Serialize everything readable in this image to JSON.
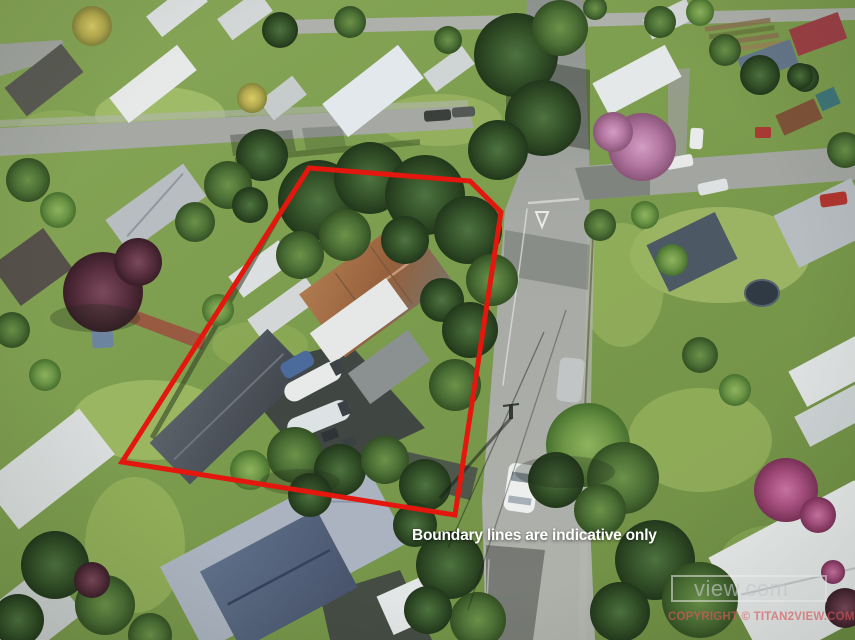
{
  "meta": {
    "type": "aerial-drone-photograph",
    "subject": "suburban residential property outlined with red boundary lines"
  },
  "overlay": {
    "caption": "Boundary lines are indicative only",
    "caption_color": "#ffffff",
    "boundary_color": "#e3170d",
    "boundary_points": "309,168 470,181 501,212 455,515 122,462"
  },
  "watermarks": {
    "box_text": "view.com",
    "copyright_text": "COPYRIGHT © TITAN2VIEW.COM"
  },
  "scene": {
    "visible_features": [
      "north-south road on right with white car and give-way triangle",
      "cross street intersection at top right",
      "street along upper left with parked cars",
      "rusty corrugated-roof cottage inside boundary",
      "long dark workshop with boats parked beside it",
      "blue-grey hipped-roof house below the property",
      "pink and magenta flowering trees",
      "dense green trees and lawns"
    ]
  }
}
